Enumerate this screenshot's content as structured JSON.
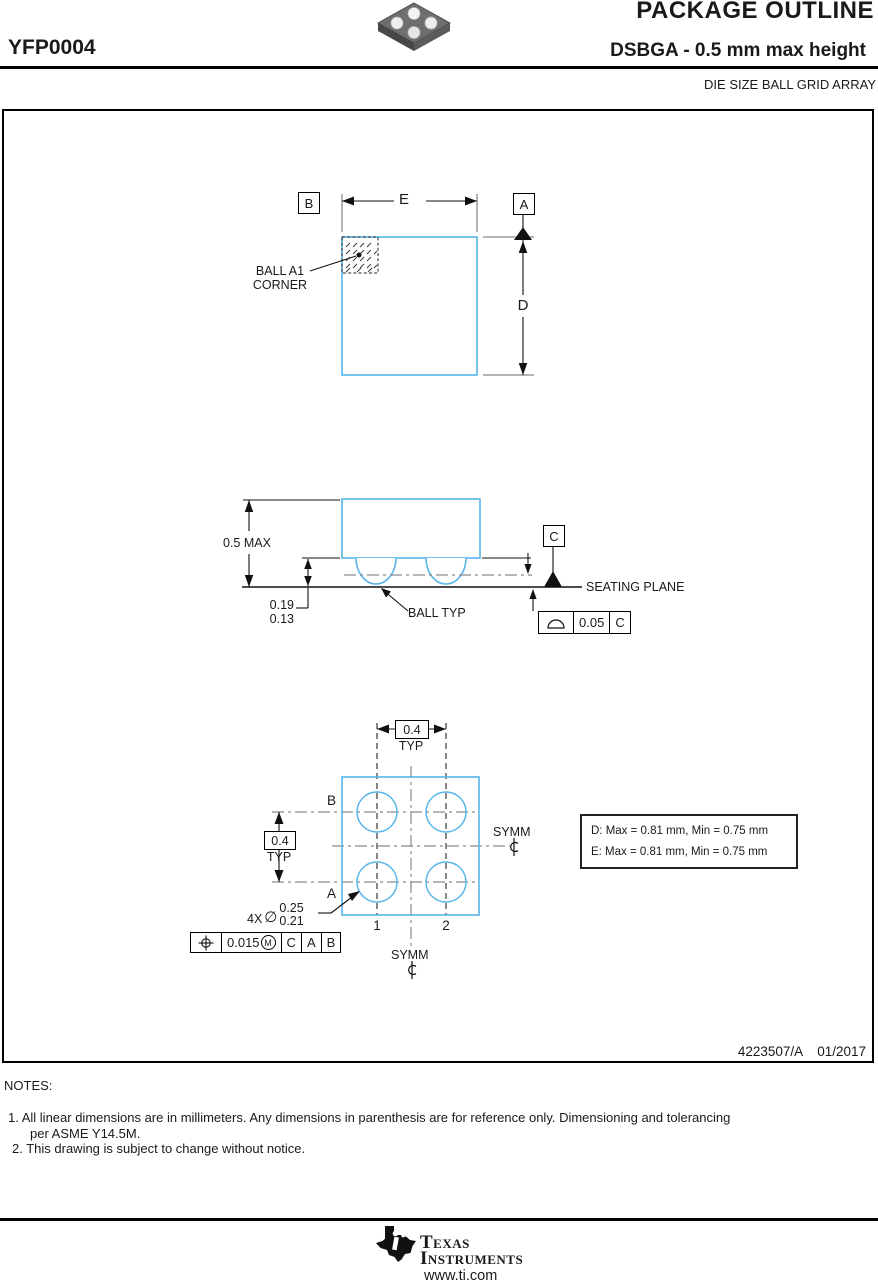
{
  "header": {
    "doc_title": "PACKAGE OUTLINE",
    "part_number": "YFP0004",
    "package_title": "DSBGA - 0.5 mm max height",
    "package_subtitle": "DIE SIZE BALL GRID ARRAY"
  },
  "colors": {
    "outline_blue": "#58B6EA",
    "line_black": "#1a1a1a",
    "centerline_gray": "#8a8a8a"
  },
  "top_view": {
    "datum_b": "B",
    "datum_a": "A",
    "dim_e": "E",
    "dim_d": "D",
    "ball_a1_line1": "BALL A1",
    "ball_a1_line2": "CORNER"
  },
  "side_view": {
    "height_max": "0.5 MAX",
    "ball_height_max": "0.19",
    "ball_height_min": "0.13",
    "ball_typ": "BALL TYP",
    "datum_c": "C",
    "seating_plane": "SEATING PLANE",
    "fcf_flatness": {
      "value": "0.05",
      "datum": "C"
    }
  },
  "bottom_view": {
    "pitch_top": "0.4",
    "pitch_top_typ": "TYP",
    "pitch_left": "0.4",
    "pitch_left_typ": "TYP",
    "row_b": "B",
    "row_a": "A",
    "col_1": "1",
    "col_2": "2",
    "symm_right": "SYMM",
    "symm_bottom": "SYMM",
    "ball_count": "4X",
    "dia_symbol": "∅",
    "ball_dia_max": "0.25",
    "ball_dia_min": "0.21",
    "fcf_position": {
      "value": "0.015",
      "modifier": "M",
      "datum1": "C",
      "datum2": "A",
      "datum3": "B"
    },
    "note_box": {
      "line1": "D: Max = 0.81 mm, Min = 0.75 mm",
      "line2": "E: Max = 0.81 mm, Min = 0.75 mm"
    }
  },
  "title_block": {
    "drawing_number": "4223507/A",
    "date": "01/2017"
  },
  "notes": {
    "heading": "NOTES:",
    "note1a": "1. All linear dimensions are in millimeters. Any dimensions in parenthesis are for reference only. Dimensioning and tolerancing",
    "note1b": "per ASME Y14.5M.",
    "note2": "2. This drawing is subject to change without notice."
  },
  "footer": {
    "brand_line1": "Texas",
    "brand_line2": "Instruments",
    "url": "www.ti.com"
  }
}
